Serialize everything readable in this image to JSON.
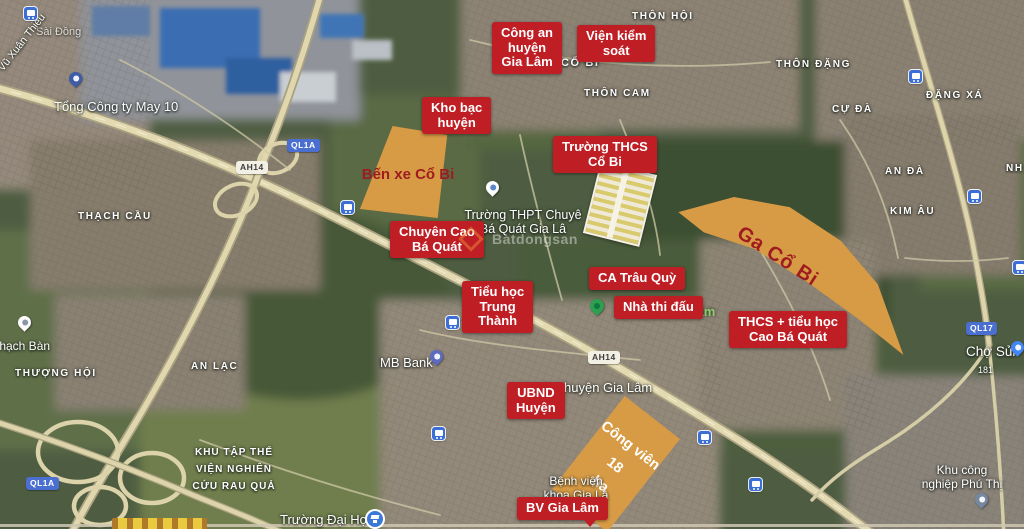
{
  "boxes": {
    "cong_an": "Công an\nhuyện\nGia Lâm",
    "vien_kiem_soat": "Viện kiểm\nsoát",
    "kho_bac": "Kho bạc\nhuyện",
    "truong_thcs": "Trường THCS\nCổ Bi",
    "chuyen_cbq": "Chuyên Cao\nBá Quát",
    "ca_trau_quy": "CA Trâu Quỳ",
    "nha_thi_dau": "Nhà thi đấu",
    "tieu_hoc": "Tiểu học\nTrung\nThành",
    "thcs_tieu_hoc_cbq": "THCS + tiểu học\nCao Bá Quát",
    "ubnd": "UBND\nHuyện",
    "bv_gia_lam": "BV Gia Lâm"
  },
  "zones": {
    "ben_xe": "Bến xe Cổ Bi",
    "ga_co_bi": "Ga Cổ Bi",
    "cong_vien": "Công viên 18\nha"
  },
  "map_labels": {
    "thon_hoi": "THÔN HỘI",
    "thon_dang": "THÔN ĐẶNG",
    "thon_cam": "THÔN CAM",
    "co_bi": "CỔ BI",
    "dang_xa": "ĐẶNG XÁ",
    "cu_da": "CỰ ĐÀ",
    "an_da": "AN ĐÀ",
    "kim_au": "KIM ÂU",
    "nh_partial": "NH",
    "thach_cau": "THẠCH CẦU",
    "thuong_hoi": "THƯỢNG HỘI",
    "an_lac": "AN LẠC",
    "thach_ban": "Thạch Bàn",
    "tong_cty": "Tổng Công ty May 10",
    "sai_dong": "Sài Đồng",
    "vu_xuan": "Vũ Xuân Thiều",
    "mb_bank": "MB Bank",
    "truong_thpt": "Trường THPT Chuyê\nBá Quát Gia Lâ",
    "huyen_gia_lam": "huyện Gia Lâm",
    "gia_lam_green": "Gia Lâm",
    "benh_vien": "Bệnh viện\nkhoa Gia Lâ",
    "truong_dai_hoc": "Trường Đại Học",
    "khu_tap_the": "KHU TẬP THỂ\nVIỆN NGHIÊN\nCỨU RAU QUẢ",
    "cho_sui": "Chợ Sủi",
    "khu_cn": "Khu công\nnghiệp Phú Thị"
  },
  "signs": {
    "ql1a_mid": "QL1A",
    "ah14_nw": "AH14",
    "ah14_mid": "AH14",
    "ql1a_sw": "QL1A",
    "ql17": "QL17",
    "route_181": "181"
  },
  "watermark": "Batdongsan",
  "colors": {
    "label_box_red": "#BE1E24",
    "zone_orange": "#D89B45",
    "zone_text_red": "#9E1B1F",
    "shield_blue": "#4A6FD0",
    "shield_white": "#F2EFE4",
    "park_green_text": "#8FCE6F"
  }
}
